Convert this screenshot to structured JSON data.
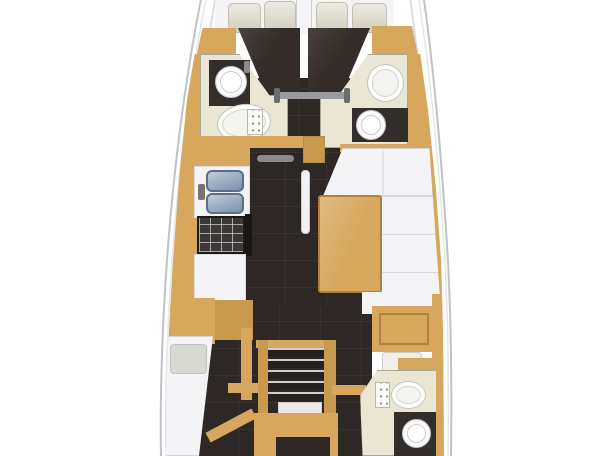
{
  "meta": {
    "type": "yacht-interior-floor-plan",
    "orientation": "bow-at-top",
    "text_labels": []
  },
  "colors": {
    "background": "#ffffff",
    "hull_fill": "#ffffff",
    "hull_outline": "#bfc2c9",
    "deck_line": "#dcdee2",
    "toe_rail": "#e4e6e9",
    "wood_tan": "#d7a75d",
    "wood_tan_dark": "#c79a4e",
    "floor_dark": "#2d2725",
    "duvet_dark": "#342c28",
    "counter_dark": "#332e2b",
    "cream_floor": "#ebe5d3",
    "cushion_white": "#f4f4f6",
    "pillow_beige": "#d9d6c4",
    "sink_blue": "#8ca3bd",
    "metal_gray": "#9a9a9e"
  },
  "rooms": [
    {
      "name": "forward-cabin-port",
      "fixtures": [
        "double-berth",
        "two-pillows",
        "dark-duvet",
        "hull-cabinet"
      ]
    },
    {
      "name": "forward-cabin-starboard",
      "fixtures": [
        "double-berth",
        "two-pillows",
        "dark-duvet",
        "hull-cabinet"
      ]
    },
    {
      "name": "head-forward-port",
      "fixtures": [
        "washbasin",
        "vanity-counter",
        "toilet",
        "control-panel"
      ]
    },
    {
      "name": "head-forward-starboard",
      "fixtures": [
        "toilet",
        "washbasin",
        "vanity-counter"
      ]
    },
    {
      "name": "galley",
      "fixtures": [
        "double-sink",
        "faucet",
        "three-burner-stove",
        "worktop",
        "hull-cabinets"
      ]
    },
    {
      "name": "saloon",
      "fixtures": [
        "dining-table",
        "l-shaped-settee",
        "fold-bench",
        "floor-hatch"
      ]
    },
    {
      "name": "aft-cabin-port",
      "fixtures": [
        "single-berth",
        "pillow",
        "cabinets",
        "bulkhead"
      ]
    },
    {
      "name": "nav-station",
      "fixtures": [
        "chart-table",
        "seat",
        "side-cabinet"
      ]
    },
    {
      "name": "head-aft-starboard",
      "fixtures": [
        "toilet",
        "control-panel",
        "washbasin",
        "vanity-counter"
      ]
    },
    {
      "name": "companionway",
      "fixtures": [
        "five-steps",
        "handrails",
        "landing",
        "engine-hatch"
      ]
    }
  ]
}
